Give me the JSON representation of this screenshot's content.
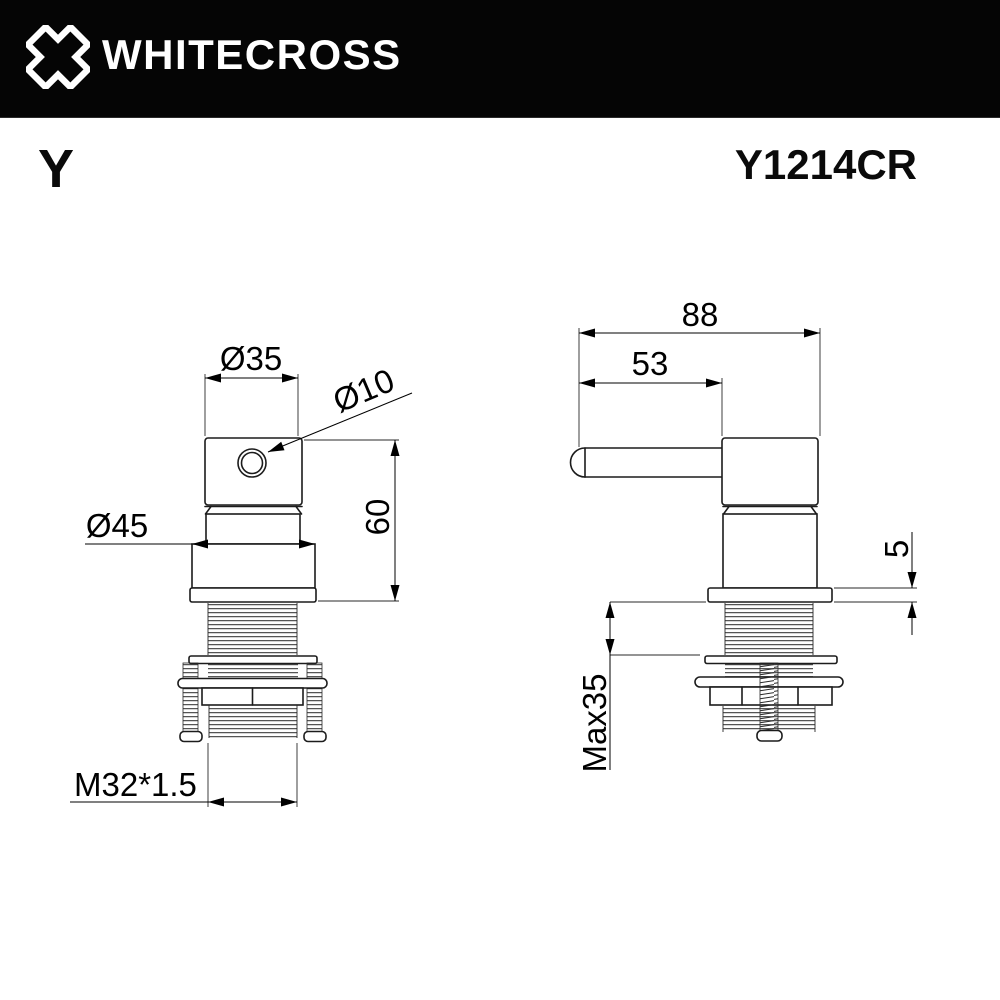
{
  "header": {
    "brand": "WHITECROSS"
  },
  "product": {
    "series": "Y",
    "model": "Y1214CR"
  },
  "front_view": {
    "dims": {
      "top_diameter": "Ø35",
      "hole_diameter": "Ø10",
      "base_diameter": "Ø45",
      "body_height": "60",
      "thread_spec": "M32*1.5"
    }
  },
  "side_view": {
    "dims": {
      "total_length": "88",
      "handle_length": "53",
      "flange_thickness": "5",
      "max_mounting_thickness": "Max35"
    }
  },
  "colors": {
    "header_bg": "#050505",
    "header_fg": "#ffffff",
    "line": "#1c1c1c",
    "background": "#ffffff"
  }
}
